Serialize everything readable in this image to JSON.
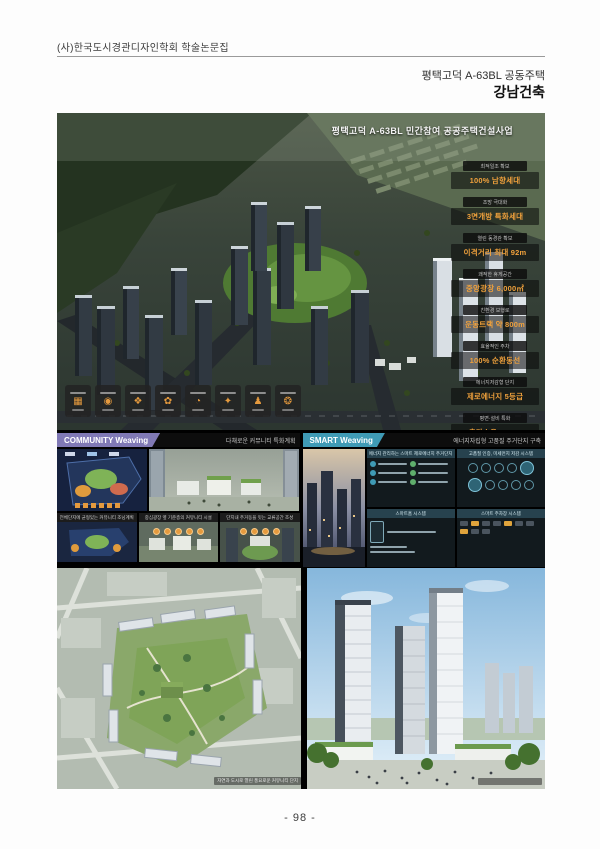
{
  "page": {
    "header_title": "(사)한국도시경관디자인학회 학술논문집",
    "doc_subtitle": "평택고덕 A-63BL 공동주택",
    "doc_author": "강남건축",
    "page_number": "- 98 -"
  },
  "board": {
    "hero_title": "평택고덕 A-63BL 민간참여 공공주택건설사업",
    "stats": [
      {
        "label": "최적일조 확보",
        "value": "100% 남향세대"
      },
      {
        "label": "조망 극대화",
        "value": "3면개방 특화세대"
      },
      {
        "label": "열린 동경관 확보",
        "value": "이격거리 최대 92m"
      },
      {
        "label": "쾌적한 휴게공간",
        "value": "중앙광장 6,000㎡"
      },
      {
        "label": "친환경 보행로",
        "value": "운동트랙 약 800m"
      },
      {
        "label": "효율적인 주차",
        "value": "100% 순환동선"
      },
      {
        "label": "에너지저감형 단지",
        "value": "제로에너지 5등급"
      },
      {
        "label": "평면·설비 특화",
        "value": "층간소음 ZERO"
      }
    ],
    "icons": [
      {
        "name": "site-plan-icon",
        "glyph": "▦"
      },
      {
        "name": "coin-icon",
        "glyph": "◉"
      },
      {
        "name": "globe-icon",
        "glyph": "❖"
      },
      {
        "name": "leaf-icon",
        "glyph": "✿"
      },
      {
        "name": "clock-icon",
        "glyph": "◔"
      },
      {
        "name": "badge-icon",
        "glyph": "✦"
      },
      {
        "name": "person-icon",
        "glyph": "♟"
      },
      {
        "name": "burst-icon",
        "glyph": "❂"
      }
    ],
    "community": {
      "badge": "COMMUNITY Weaving",
      "tagline": "다채로운 커뮤니티 특화계획",
      "captions": [
        "전체단지에 균형있는 커뮤니티 조닝계획",
        "중심광장 옆 기준층의 커뮤니티 시설",
        "단지내 주거동을 잇는 교류공간 조성"
      ]
    },
    "smart": {
      "badge": "SMART Weaving",
      "tagline": "에너지자립형 고품질 주거단지 구축",
      "panel1_title": "에너지 관리하는 스마트 제로에너지 주거단지",
      "panel2_title": "고품질 인증, 미세먼지 저감 시스템",
      "panel3_title": "스마트홈 시스템",
      "panel4_title": "스마트 주차장 시스템"
    },
    "bottom_left_caption": "자연과 도시로 열린 풍요로운 커뮤니티 단지",
    "colors": {
      "accent_orange": "#f0a13c",
      "community_badge": "#8079b5",
      "smart_badge": "#3f9ab5"
    }
  }
}
